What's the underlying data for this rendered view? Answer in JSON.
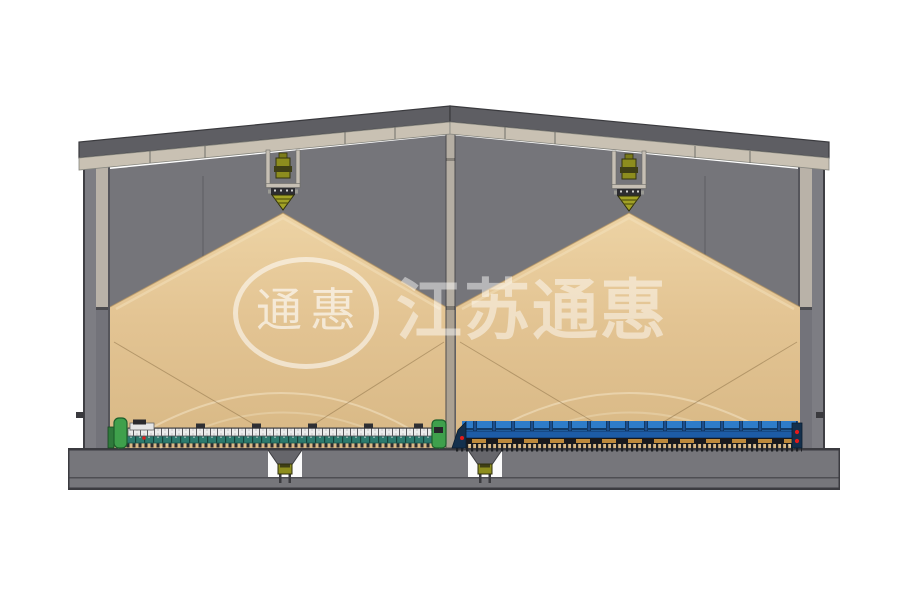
{
  "watermark": {
    "seal_text": "通惠",
    "brand_text": "江苏通惠"
  },
  "palette": {
    "wall_gray": "#75757a",
    "roof_gray": "#5e5e63",
    "fascia_beige": "#c9c1b3",
    "grain_tan": "#e3c493",
    "foundation_gray": "#76767b",
    "column_beige": "#b5aea3",
    "spreader_olive": "#8d8d1e",
    "conveyor_left_green": "#3fa04c",
    "conveyor_left_teal": "#2c7a6e",
    "conveyor_right_blue": "#2e7cc9",
    "conveyor_right_tan": "#bd8a3c",
    "accent_red": "#e01818"
  }
}
